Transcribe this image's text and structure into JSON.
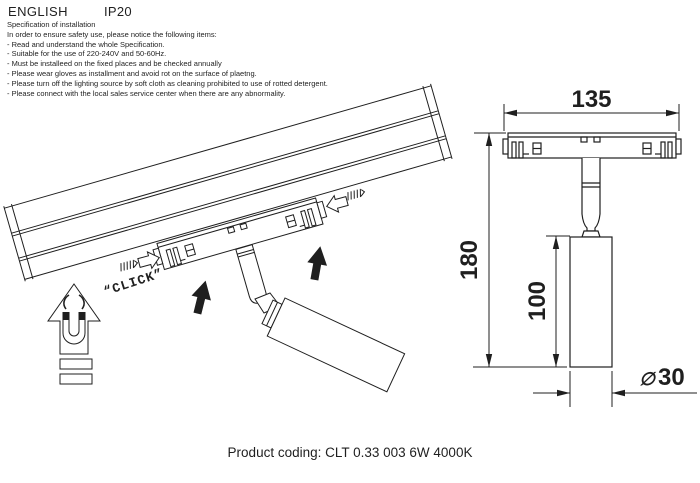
{
  "page": {
    "background": "#ffffff",
    "ink": "#1f1f1f"
  },
  "header": {
    "language_label": "ENGLISH",
    "ip_rating": "IP20"
  },
  "specification": {
    "title": "Specification of installation",
    "intro": "In order to ensure safety use, please notice the following items:",
    "items": [
      "- Read and understand the whole Specification.",
      "- Suitable for the use of 220-240V and 50-60Hz.",
      "- Must be installeed on the fixed places and be checked annually",
      "- Please wear gloves as installment and avoid rot on the surface of plaetng.",
      "- Please turn off the lighting source by soft cloth as cleaning prohibited to use of rotted detergent.",
      "- Please connect with the local sales service center when there are any abnormality."
    ]
  },
  "installation_diagram": {
    "click_label": "“CLICK”"
  },
  "dimensions": {
    "width": "135",
    "height": "180",
    "body_height": "100",
    "diameter_symbol": "∅",
    "diameter_value": "30"
  },
  "footer": {
    "product_coding": "Product coding: CLT 0.33 003 6W 4000K"
  }
}
